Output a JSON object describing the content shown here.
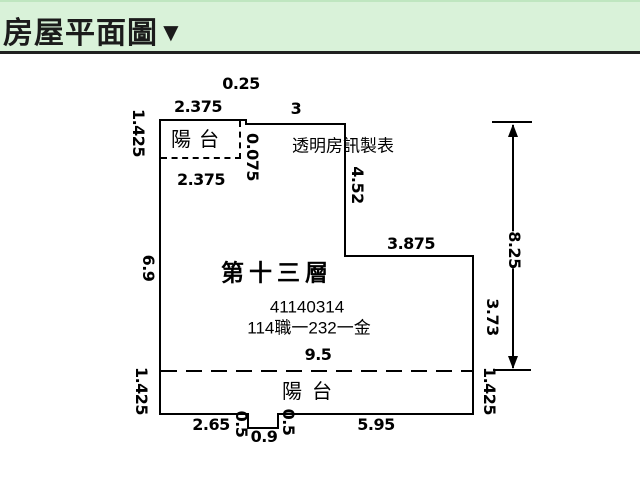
{
  "header": {
    "title": "房屋平面圖",
    "collapse_icon": "▼"
  },
  "colors": {
    "header_bg": "#d9f2d9",
    "header_text": "#1b1b1b",
    "plan_lines": "#000000",
    "canvas_bg": "#ffffff"
  },
  "plan": {
    "maker": "透明房訊製表",
    "floor": "第十三層",
    "reg_number": "41140314",
    "case_number": "114職一232一金",
    "balcony_top": "陽台",
    "balcony_bottom": "陽台"
  },
  "dimensions": {
    "top_jog_width": "0.25",
    "top_balcony_width": "2.375",
    "top_main_width": "3",
    "left_top_height": "1.425",
    "jog_height": "0.075",
    "balcony_inner_width": "2.375",
    "right_upper_height": "4.52",
    "left_mid_height": "6.9",
    "step_width": "3.875",
    "interior_width": "9.5",
    "overall_right_height": "8.25",
    "right_lower_height": "3.73",
    "right_bottom_height": "1.425",
    "left_bottom_height": "1.425",
    "bottom_left_width": "2.65",
    "notch_left_depth": "0.5",
    "notch_width": "0.9",
    "notch_right_depth": "0.5",
    "bottom_right_width": "5.95"
  }
}
